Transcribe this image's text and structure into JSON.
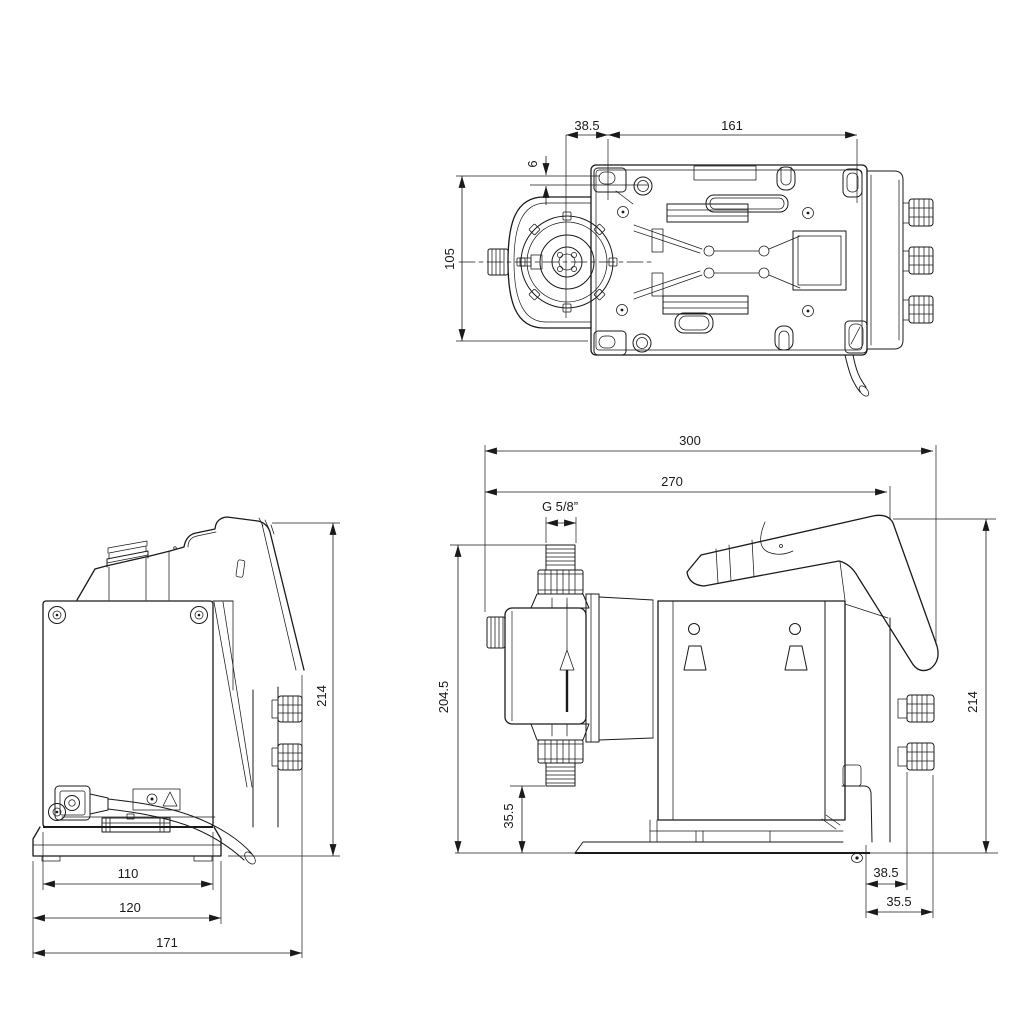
{
  "palette": {
    "background": "#ffffff",
    "line": "#1a1a1a"
  },
  "views": {
    "top": {
      "dims": {
        "head_center_offset": "38.5",
        "mount_hole_spacing_length": "161",
        "slot_offset": "6",
        "mount_hole_spacing_width": "105"
      }
    },
    "back": {
      "dims": {
        "overall_height": "214",
        "base_inner_width": "110",
        "base_width": "120",
        "overall_width": "171"
      }
    },
    "side": {
      "dims": {
        "overall_depth": "300",
        "depth_to_panel_edge": "270",
        "connection_thread": "G 5/8”",
        "head_connection_height": "204.5",
        "suction_connection_clearance": "35.5",
        "overall_height": "214",
        "rear_mount_offset": "38.5",
        "rear_overhang": "35.5"
      }
    }
  }
}
